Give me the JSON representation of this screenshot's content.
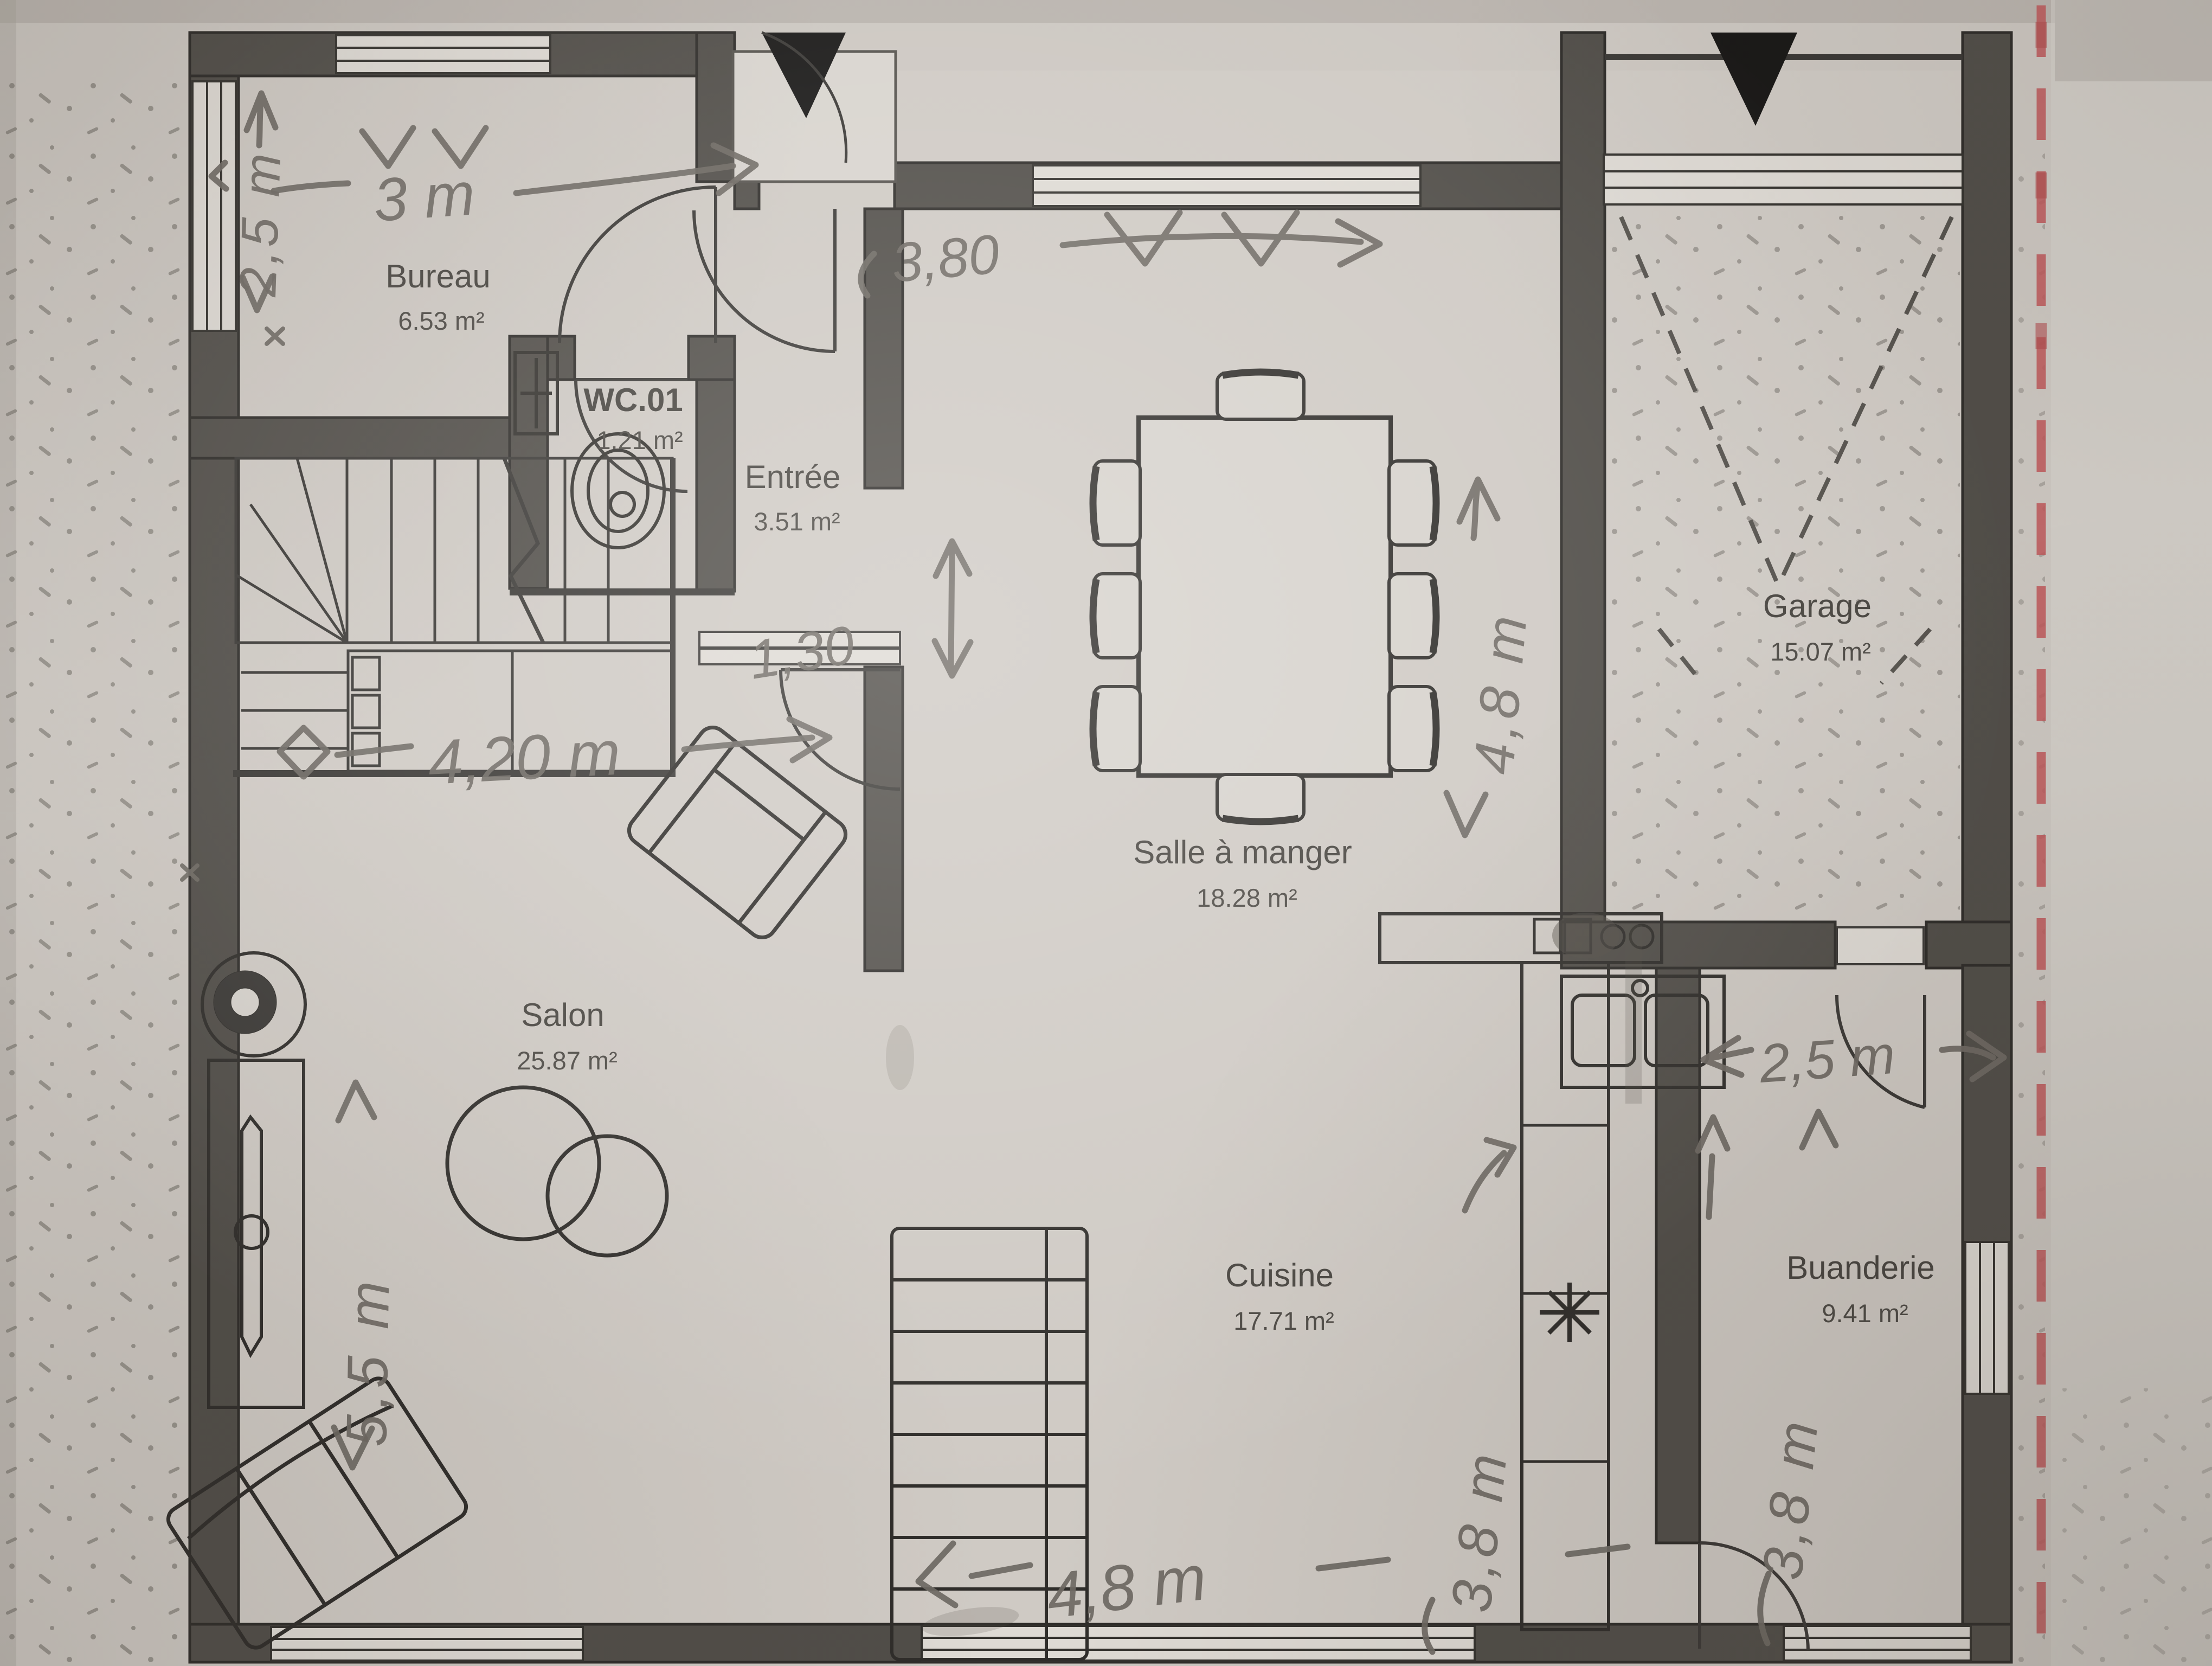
{
  "document_type": "floor-plan-photo",
  "rooms": {
    "bureau": {
      "name": "Bureau",
      "area": "6.53 m²"
    },
    "wc": {
      "name": "WC.01",
      "area": "1.21 m²"
    },
    "entree": {
      "name": "Entrée",
      "area": "3.51 m²"
    },
    "salle_a_manger": {
      "name": "Salle à manger",
      "area": "18.28 m²"
    },
    "garage": {
      "name": "Garage",
      "area": "15.07 m²"
    },
    "salon": {
      "name": "Salon",
      "area": "25.87 m²"
    },
    "cuisine": {
      "name": "Cuisine",
      "area": "17.71 m²"
    },
    "buanderie": {
      "name": "Buanderie",
      "area": "9.41 m²"
    }
  },
  "dims": {
    "left_height": {
      "text": "2,5 m"
    },
    "bureau_width": {
      "text": "3 m"
    },
    "salle_width": {
      "text": "3,80"
    },
    "salle_height": {
      "text": "4,8 m"
    },
    "entree_depth": {
      "text": "1,30"
    },
    "hall_width": {
      "text": "4,20 m"
    },
    "salon_height": {
      "text": "5,5 m"
    },
    "cuisine_height": {
      "text": "3,8 m"
    },
    "buanderie_height": {
      "text": "3,8 m"
    },
    "buanderie_width": {
      "text": "2,5 m"
    },
    "bottom_width": {
      "text": "4,8 m"
    }
  },
  "colors": {
    "paper": "#ccc7c1",
    "wall": "#504d48",
    "pencil": "#6e6963",
    "boundary_red": "#bf585a"
  }
}
